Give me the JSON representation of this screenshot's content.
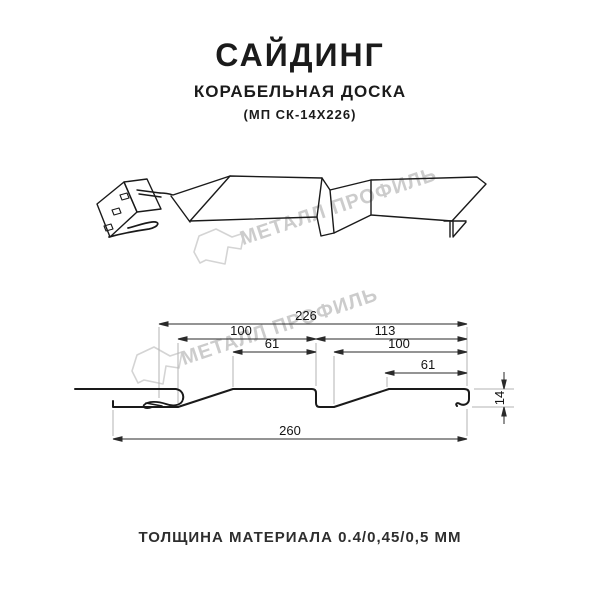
{
  "header": {
    "title": "САЙДИНГ",
    "subtitle": "КОРАБЕЛЬНАЯ ДОСКА",
    "model": "(МП СК-14Х226)"
  },
  "watermark": {
    "brand": "МЕТАЛЛ ПРОФИЛЬ"
  },
  "dimensions": {
    "coverage_width": "226",
    "board1_width": "100",
    "board2_width": "113",
    "board1_face": "61",
    "board2_face": "100",
    "board2_face_small": "61",
    "overall_width": "260",
    "profile_depth": "14"
  },
  "footer": {
    "thickness_note": "ТОЛЩИНА МАТЕРИАЛА 0.4/0,45/0,5 ММ"
  }
}
